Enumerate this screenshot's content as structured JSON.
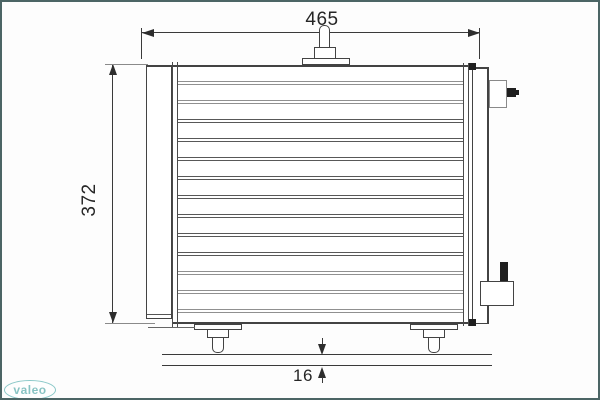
{
  "dimensions": {
    "width": {
      "label": "465"
    },
    "height": {
      "label": "372"
    },
    "depth": {
      "label": "16"
    }
  },
  "logo": {
    "text": "valeo",
    "color": "#2f9e9e"
  },
  "drawing": {
    "type": "technical-drawing-condenser-front-view",
    "tube_count": 13,
    "tube_light_indexes": [
      0,
      1,
      10,
      11,
      12
    ],
    "colors": {
      "frame_border": "#4c6565",
      "outline_dark": "#3a3a3a",
      "outline_gray": "#8a8a8a",
      "pin_black": "#1f1f1f",
      "logo_teal": "#2f9e9e"
    }
  }
}
